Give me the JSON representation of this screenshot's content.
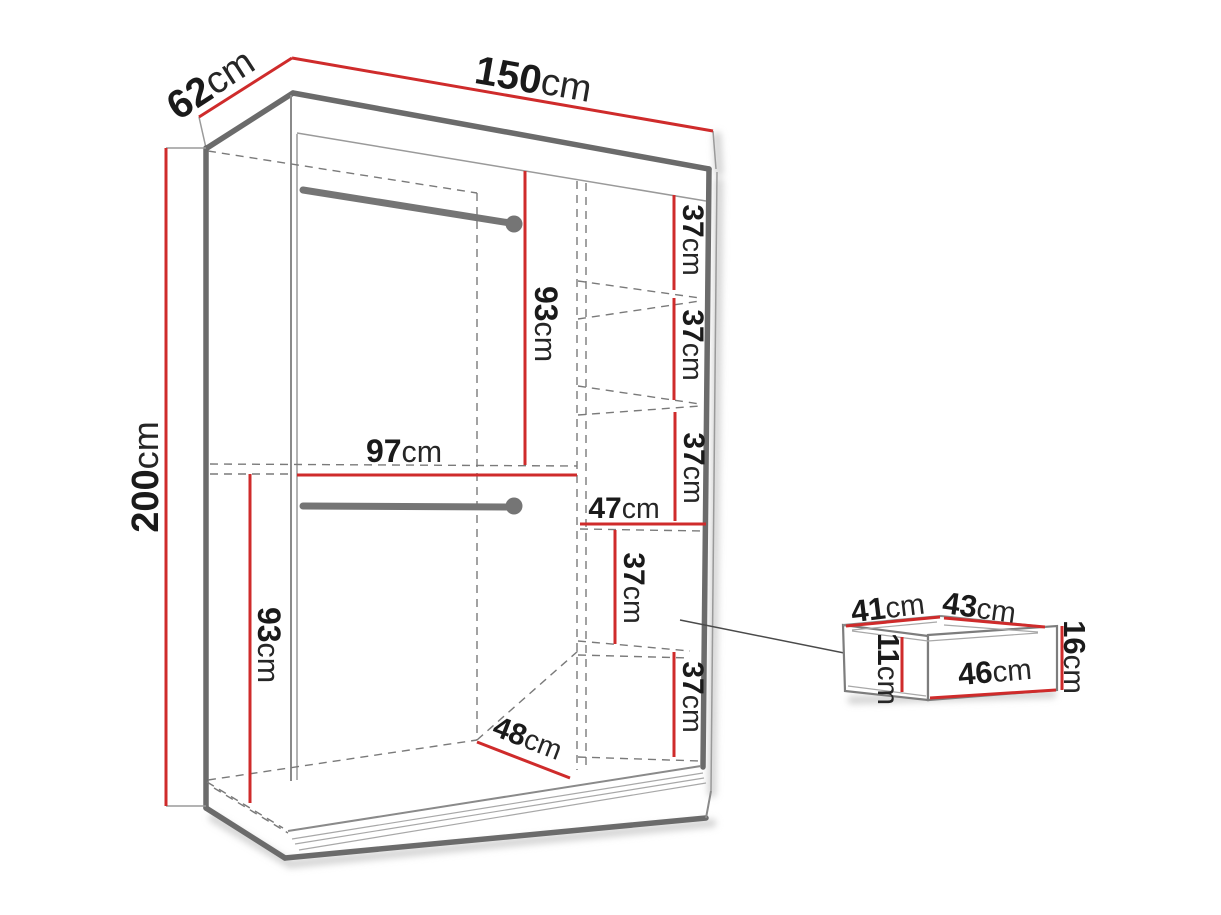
{
  "figure": {
    "kind": "furniture-dimension-diagram",
    "subject": "sliding-door wardrobe with shelf column and drawer detail",
    "background": "#ffffff"
  },
  "colors": {
    "dimension_line": "#cf2b2b",
    "outline": "#6b6b6b",
    "thin_line": "#9a9a9a",
    "dashed_line": "#7a7a7a",
    "text": "#1a1a1a"
  },
  "labels": {
    "depth": {
      "value": "62",
      "unit": "cm"
    },
    "width": {
      "value": "150",
      "unit": "cm"
    },
    "height": {
      "value": "200",
      "unit": "cm"
    },
    "upper_hang_height": {
      "value": "93",
      "unit": "cm"
    },
    "inner_width": {
      "value": "97",
      "unit": "cm"
    },
    "lower_hang_height": {
      "value": "93",
      "unit": "cm"
    },
    "shelf_gap_1": {
      "value": "37",
      "unit": "cm"
    },
    "shelf_gap_2": {
      "value": "37",
      "unit": "cm"
    },
    "shelf_gap_3": {
      "value": "37",
      "unit": "cm"
    },
    "shelf_width": {
      "value": "47",
      "unit": "cm"
    },
    "shelf_gap_4": {
      "value": "37",
      "unit": "cm"
    },
    "shelf_gap_5": {
      "value": "37",
      "unit": "cm"
    },
    "floor_depth": {
      "value": "48",
      "unit": "cm"
    },
    "drawer_inner_depth": {
      "value": "41",
      "unit": "cm"
    },
    "drawer_top_width": {
      "value": "43",
      "unit": "cm"
    },
    "drawer_height": {
      "value": "16",
      "unit": "cm"
    },
    "drawer_inner_height": {
      "value": "11",
      "unit": "cm"
    },
    "drawer_front_width": {
      "value": "46",
      "unit": "cm"
    }
  }
}
